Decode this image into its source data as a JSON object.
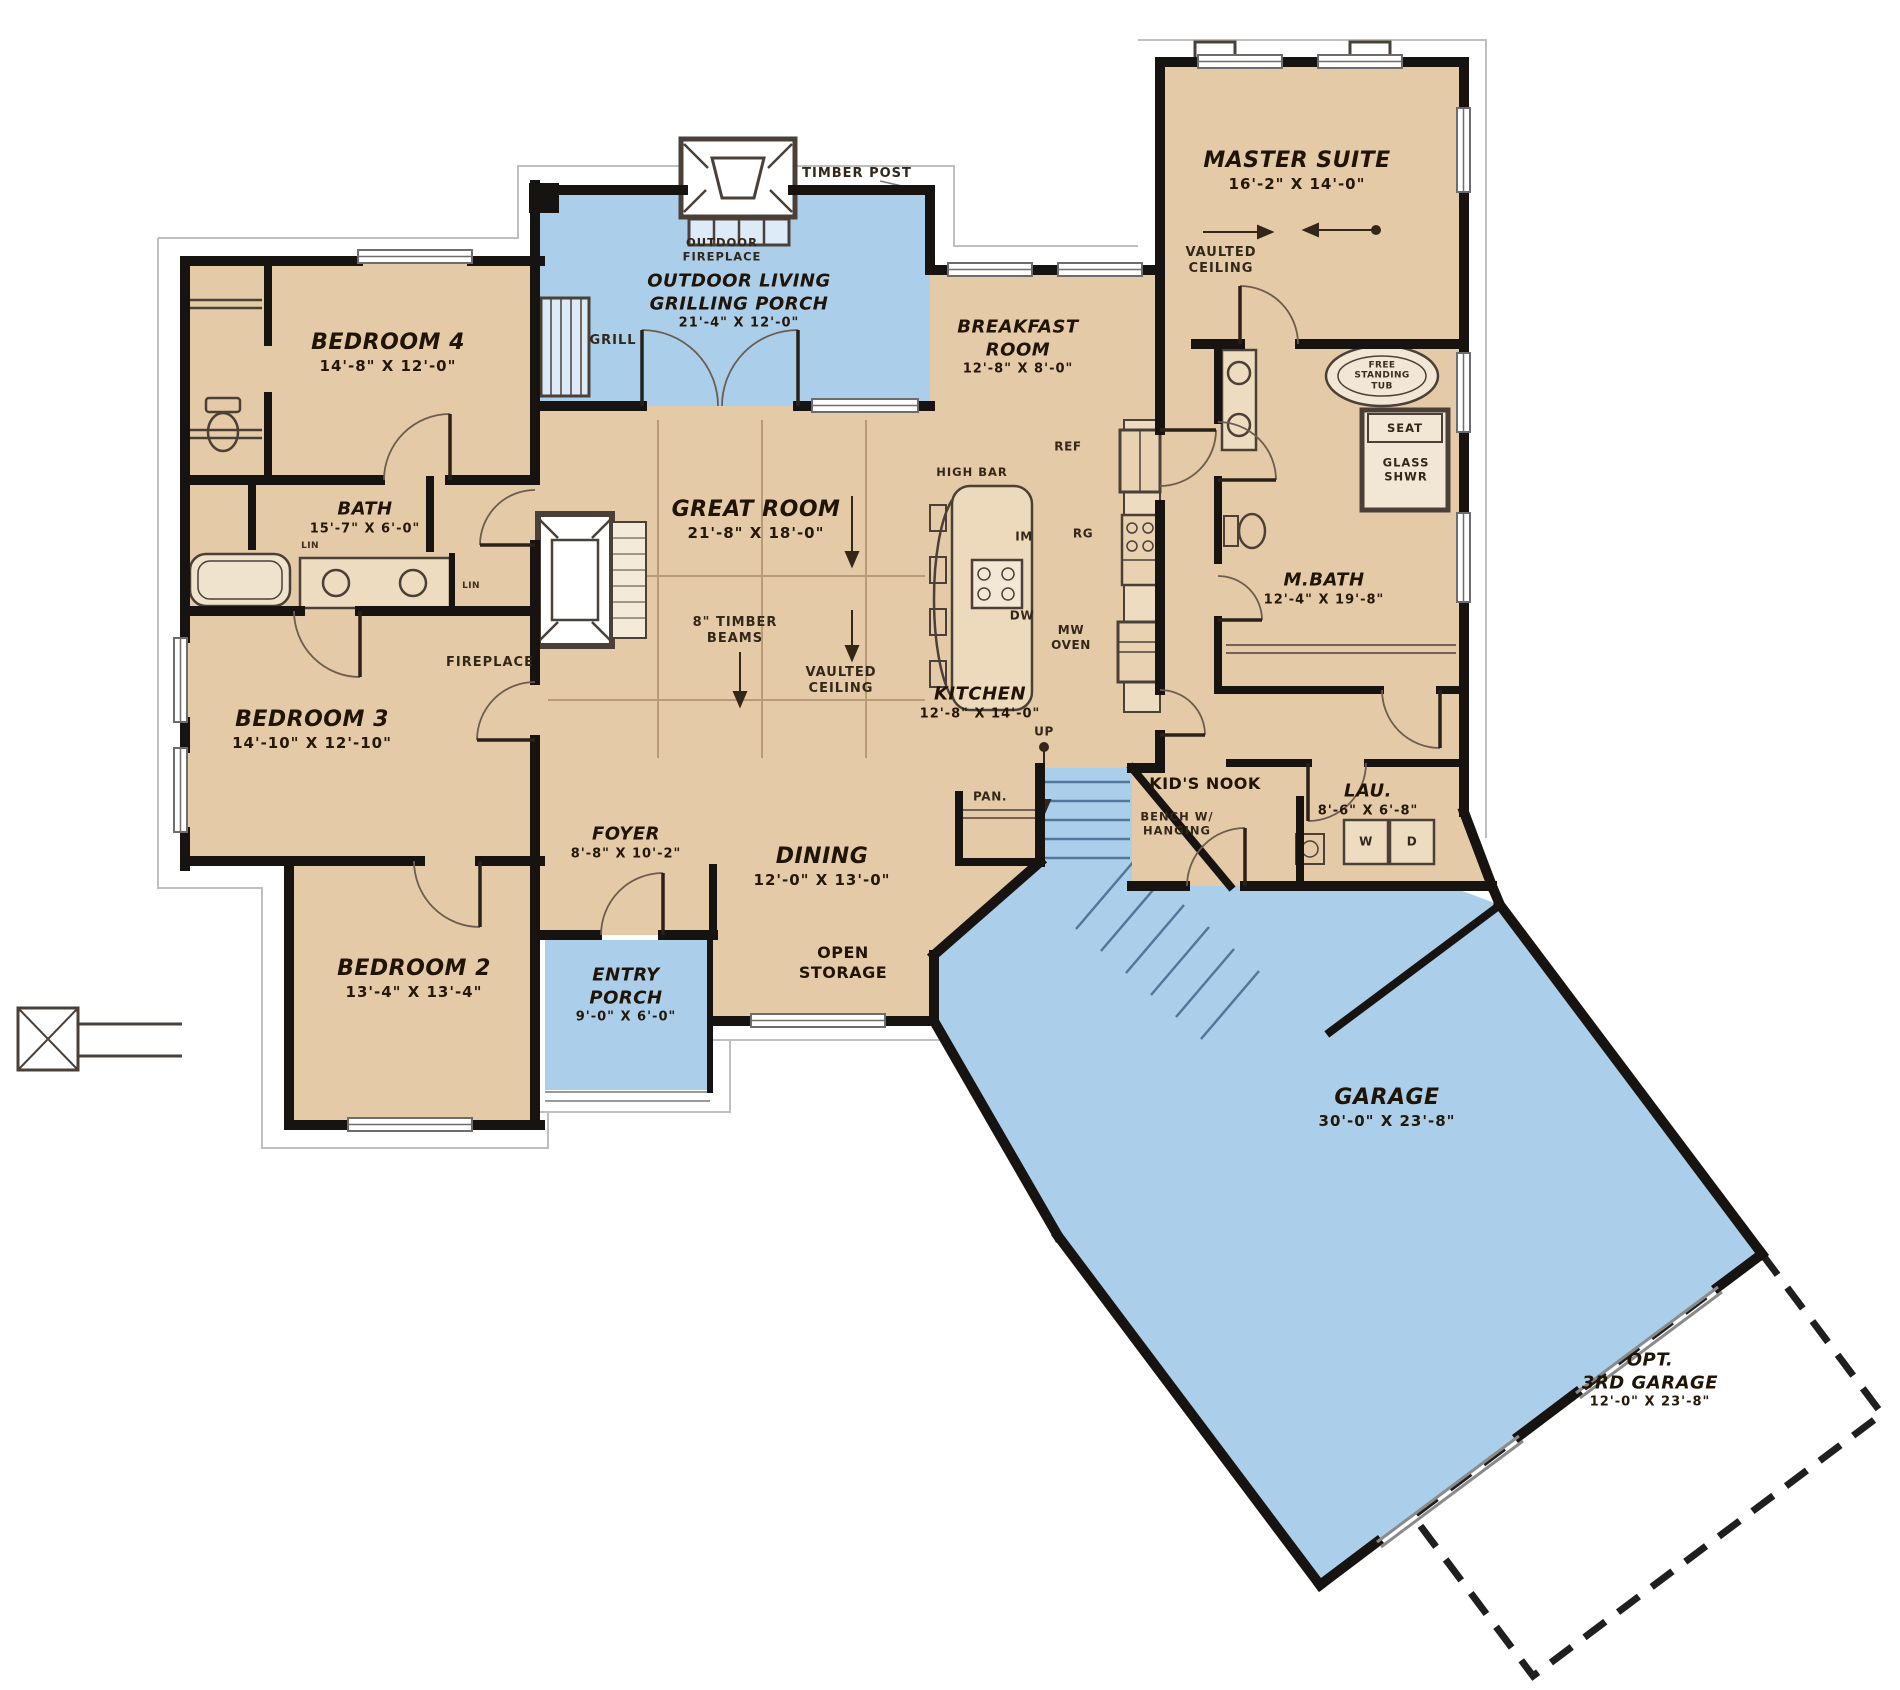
{
  "title": "House Floor Plan",
  "colors": {
    "room_fill": "#e5caa7",
    "porch_fill": "#abcfeb",
    "wall": "#171310",
    "background": "#ffffff"
  },
  "rooms": {
    "master_suite": {
      "name": "MASTER SUITE",
      "dims": "16'-2\" X 14'-0\""
    },
    "breakfast_room": {
      "name_line1": "BREAKFAST",
      "name_line2": "ROOM",
      "dims": "12'-8\" X 8'-0\""
    },
    "bedroom4": {
      "name": "BEDROOM 4",
      "dims": "14'-8\" X 12'-0\""
    },
    "bath": {
      "name": "BATH",
      "dims": "15'-7\" X 6'-0\""
    },
    "bedroom3": {
      "name": "BEDROOM 3",
      "dims": "14'-10\" X 12'-10\""
    },
    "bedroom2": {
      "name": "BEDROOM 2",
      "dims": "13'-4\" X 13'-4\""
    },
    "great_room": {
      "name": "GREAT ROOM",
      "dims": "21'-8\" X 18'-0\""
    },
    "kitchen": {
      "name": "KITCHEN",
      "dims": "12'-8\" X 14'-0\""
    },
    "dining": {
      "name": "DINING",
      "dims": "12'-0\" X 13'-0\""
    },
    "foyer": {
      "name": "FOYER",
      "dims": "8'-8\" X 10'-2\""
    },
    "entry_porch": {
      "name_line1": "ENTRY",
      "name_line2": "PORCH",
      "dims": "9'-0\" X 6'-0\""
    },
    "grilling_porch": {
      "name_line1": "OUTDOOR LIVING",
      "name_line2": "GRILLING PORCH",
      "dims": "21'-4\" X 12'-0\""
    },
    "master_bath": {
      "name": "M.BATH",
      "dims": "12'-4\" X 19'-8\""
    },
    "laundry": {
      "name": "LAU.",
      "dims": "8'-6\" X 6'-8\""
    },
    "kids_nook": {
      "name": "KID'S NOOK"
    },
    "open_storage": {
      "name_line1": "OPEN",
      "name_line2": "STORAGE"
    },
    "garage": {
      "name": "GARAGE",
      "dims": "30'-0\" X 23'-8\""
    },
    "opt_third_garage": {
      "name_line1": "OPT.",
      "name_line2": "3RD GARAGE",
      "dims": "12'-0\" X 23'-8\""
    }
  },
  "annotations": {
    "timber_post": "TIMBER POST",
    "outdoor_fireplace_line1": "OUTDOOR",
    "outdoor_fireplace_line2": "FIREPLACE",
    "grill": "GRILL",
    "vaulted_line1": "VAULTED",
    "vaulted_line2": "CEILING",
    "timber_beams_line1": "8\" TIMBER",
    "timber_beams_line2": "BEAMS",
    "fireplace": "FIREPLACE",
    "high_bar": "HIGH BAR",
    "ref": "REF",
    "range": "RG",
    "ice_maker": "IM",
    "dishwasher": "DW",
    "mw": "MW",
    "oven": "OVEN",
    "pantry": "PAN.",
    "up": "UP",
    "bench_line1": "BENCH W/",
    "bench_line2": "HANGING",
    "linen": "LIN",
    "seat": "SEAT",
    "glass_shower_line1": "GLASS",
    "glass_shower_line2": "SHWR",
    "tub_line1": "FREE",
    "tub_line2": "STANDING",
    "tub_line3": "TUB",
    "washer": "W",
    "dryer": "D"
  }
}
